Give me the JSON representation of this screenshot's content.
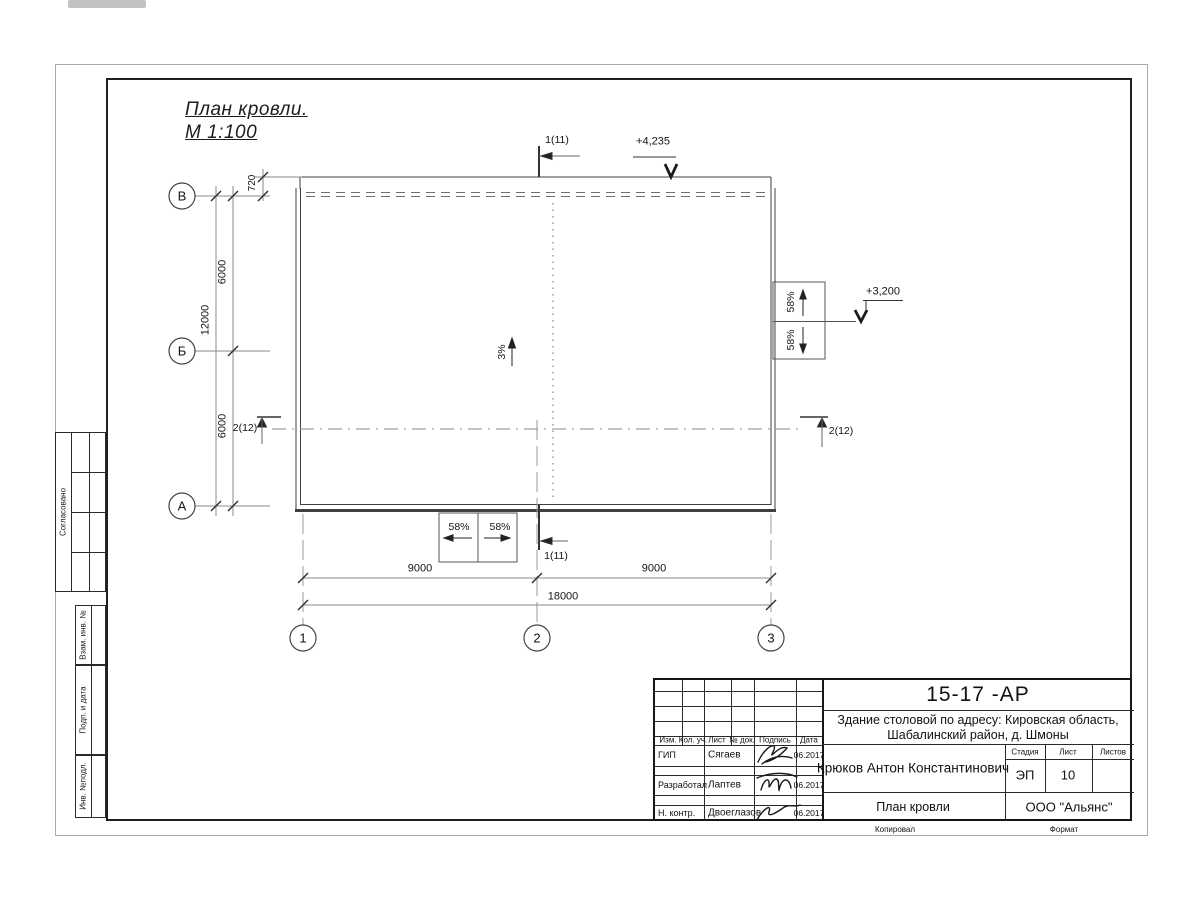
{
  "title": {
    "line1": "План кровли.",
    "line2": "М 1:100"
  },
  "dimensions": {
    "v720": "720",
    "v6000_top": "6000",
    "v12000": "12000",
    "v6000_bot": "6000",
    "h9000_l": "9000",
    "h9000_r": "9000",
    "h18000": "18000"
  },
  "sections": {
    "s1": "1(11)",
    "s2": "2(12)"
  },
  "elevations": {
    "roof": "+4,235",
    "canopy": "+3,200"
  },
  "slopes": {
    "main": "3%",
    "canopy": "58%"
  },
  "axes": {
    "rows": [
      "В",
      "Б",
      "А"
    ],
    "cols": [
      "1",
      "2",
      "3"
    ]
  },
  "sidebar": {
    "agreed": "Согласовано",
    "replace_inv": "Взам. инв. №",
    "sign_date": "Подп. и дата",
    "inv_orig": "Инв. №подл."
  },
  "title_block": {
    "doc_number": "15-17 -АР",
    "project_line1": "Здание столовой по адресу: Кировская область,",
    "project_line2": "Шабалинский район, д. Шмоны",
    "author": "Крюков Антон Константинович",
    "drawing_name": "План кровли",
    "company": "ООО \"Альянс\"",
    "stage_label": "Стадия",
    "sheet_label": "Лист",
    "sheets_label": "Листов",
    "stage_value": "ЭП",
    "sheet_value": "10",
    "columns": [
      "Изм.",
      "Кол. уч.",
      "Лист",
      "№ док.",
      "Подпись",
      "Дата"
    ],
    "rows": [
      {
        "role": "ГИП",
        "name": "Сягаев",
        "date": "06.2017"
      },
      {
        "role": "Разработал",
        "name": "Лаптев",
        "date": "06.2017"
      },
      {
        "role": "Н. контр.",
        "name": "Двоеглазов",
        "date": "06.2017"
      }
    ],
    "footer_copied": "Копировал",
    "footer_format": "Формат"
  }
}
